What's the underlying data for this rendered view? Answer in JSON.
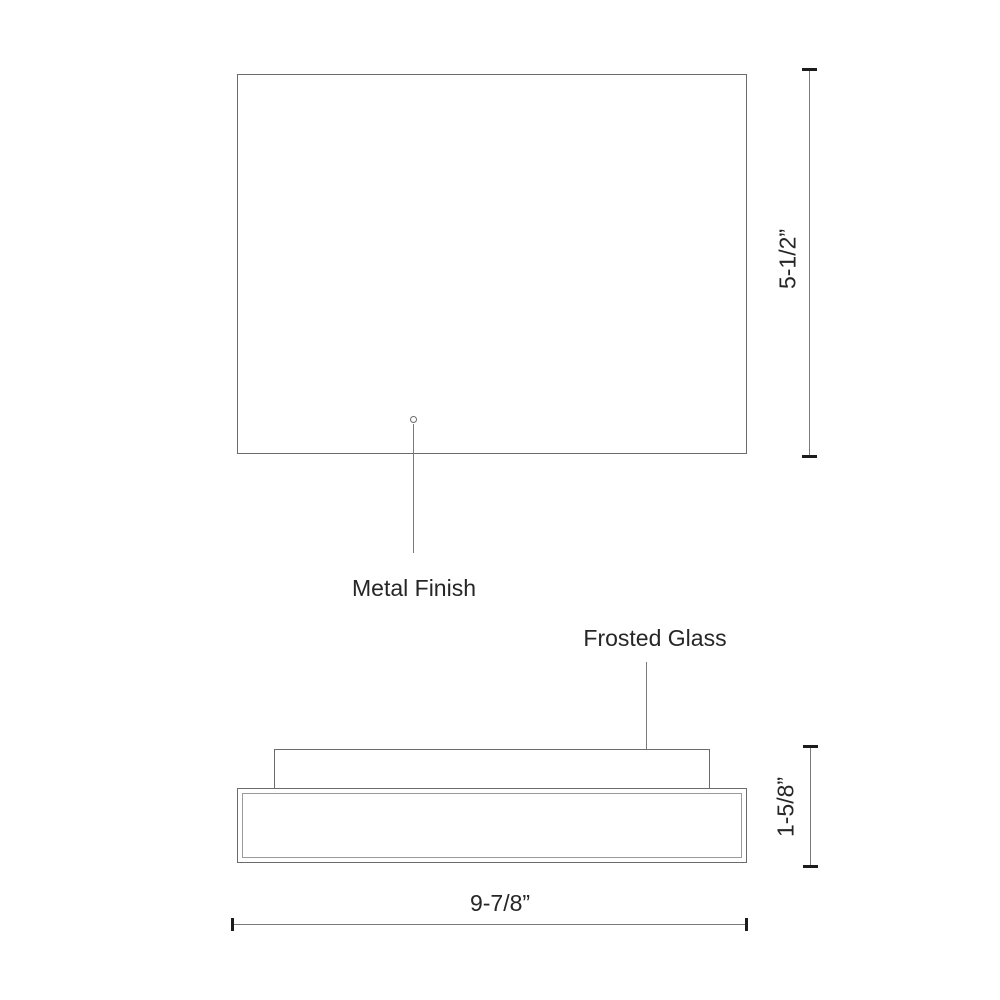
{
  "drawing": {
    "title": "Flush mount fixture dimension drawing",
    "views": {
      "top_view": "top-outline",
      "side_view": "side-profile"
    },
    "callouts": {
      "metal_finish": "Metal Finish",
      "frosted_glass": "Frosted Glass"
    },
    "dimensions": {
      "height": "5-1/2”",
      "depth": "1-5/8”",
      "width": "9-7/8”"
    },
    "colors": {
      "background": "#ffffff",
      "line": "#6b6b6b",
      "inner_line": "#9a9a9a",
      "dimension_line": "#7a7a7a",
      "tick": "#1c1c1c",
      "text": "#262626"
    }
  }
}
